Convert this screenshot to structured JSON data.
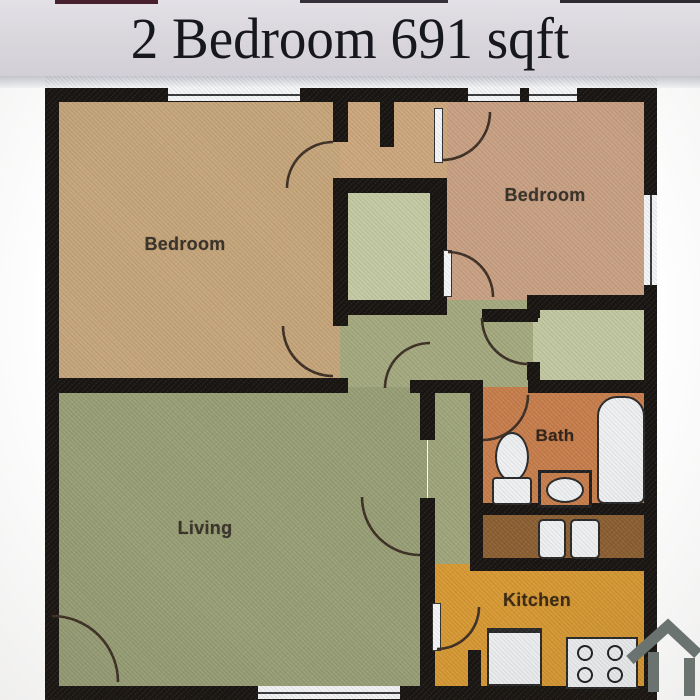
{
  "header": {
    "title": "2 Bedroom 691 sqft"
  },
  "floor_plan": {
    "rooms": {
      "bedroom_left": {
        "label": "Bedroom"
      },
      "bedroom_right": {
        "label": "Bedroom"
      },
      "living": {
        "label": "Living"
      },
      "bath": {
        "label": "Bath"
      },
      "kitchen": {
        "label": "Kitchen"
      }
    },
    "fixtures": [
      "bathtub",
      "toilet",
      "vanity-sink",
      "washer",
      "dryer",
      "refrigerator",
      "stove-4-burner"
    ],
    "features": [
      "door-swing-arcs",
      "windows",
      "closets",
      "entry-door"
    ],
    "logo": "house-icon",
    "colors": {
      "title_bar_bg": "#d8d6db",
      "title_text": "#17171e",
      "walls": "#1a1613",
      "bedroom_left": "#c6a67c",
      "bedroom_right": "#c9a184",
      "living": "#99a077",
      "closet_green": "#c4caa4",
      "hall": "#a5aa80",
      "bath": "#c87f4e",
      "laundry": "#8d6134",
      "kitchen": "#d89a35",
      "fixture_white": "#eef0f2",
      "logo_gray": "#6b7370"
    }
  }
}
